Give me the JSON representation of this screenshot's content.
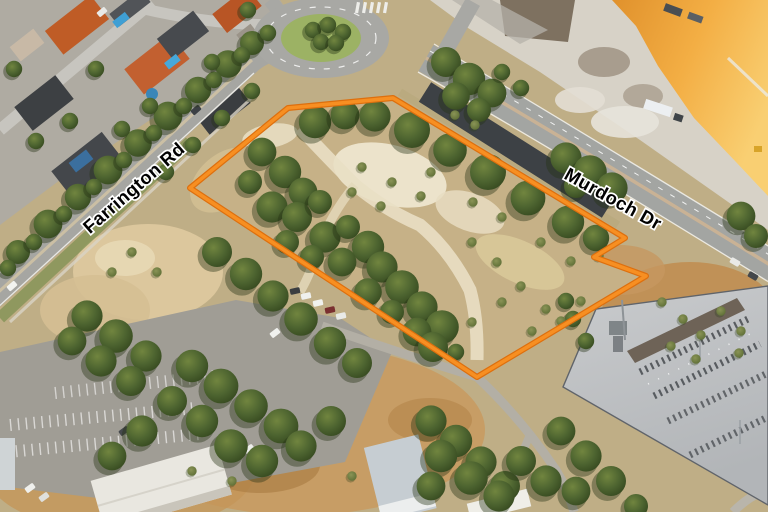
{
  "view": {
    "width": 768,
    "height": 512
  },
  "overlay": {
    "boundary": {
      "color": "#f78f22",
      "outline_color": "#dd6f0e",
      "points": "190,188 288,108 393,98 625,238 594,257 646,276 477,377"
    },
    "road_labels": [
      {
        "text": "Farrington Rd",
        "text_color": "#000000",
        "halo_color": "#ffffff"
      },
      {
        "text": "Murdoch Dr",
        "text_color": "#000000",
        "halo_color": "#ffffff"
      }
    ]
  },
  "palette": {
    "boundary_orange": "#f78f22",
    "quarry_sand_orange": "#f3ae44",
    "bushland_tan": "#c2ab80",
    "vegetation_green": "#4d6430",
    "road_gray": "#a6a6a2",
    "new_asphalt_dark": "#3d4145",
    "substation_concrete": "#c0c3c5",
    "dry_field_tan": "#c89a5f"
  }
}
